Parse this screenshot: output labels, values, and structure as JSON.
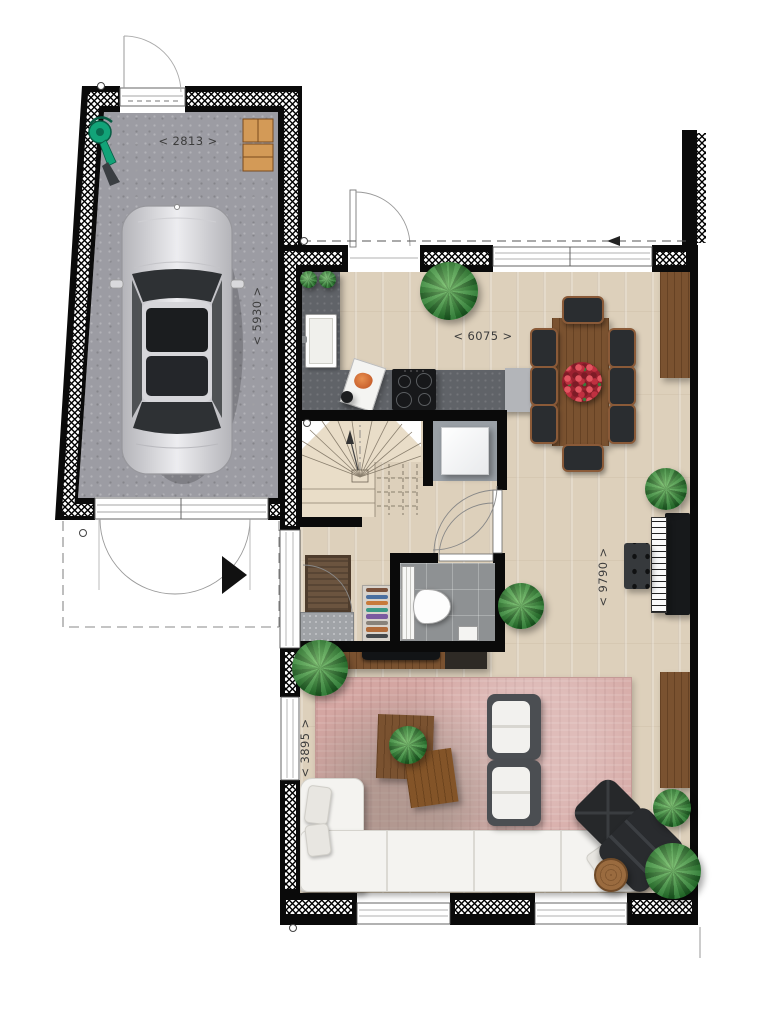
{
  "labels": {
    "garage_width": "< 2813 >",
    "garage_depth": "< 5930 >",
    "kitchen_width": "< 6075 >",
    "living_depth": "< 9790 >",
    "living_width": "< 3895 >"
  },
  "palette": {
    "wood_floor": "#ddd0bb",
    "garage_floor": "#9c9ca3",
    "counter": "#606368",
    "rug": "#d4a6a2",
    "wall": "#0a0a0a",
    "stair_floor": "#e9ddc8",
    "tile_floor": "#8e9193",
    "wood_furniture": "#7a5230",
    "sofa": "#f4f3f0",
    "car": "#d9d9dc"
  }
}
